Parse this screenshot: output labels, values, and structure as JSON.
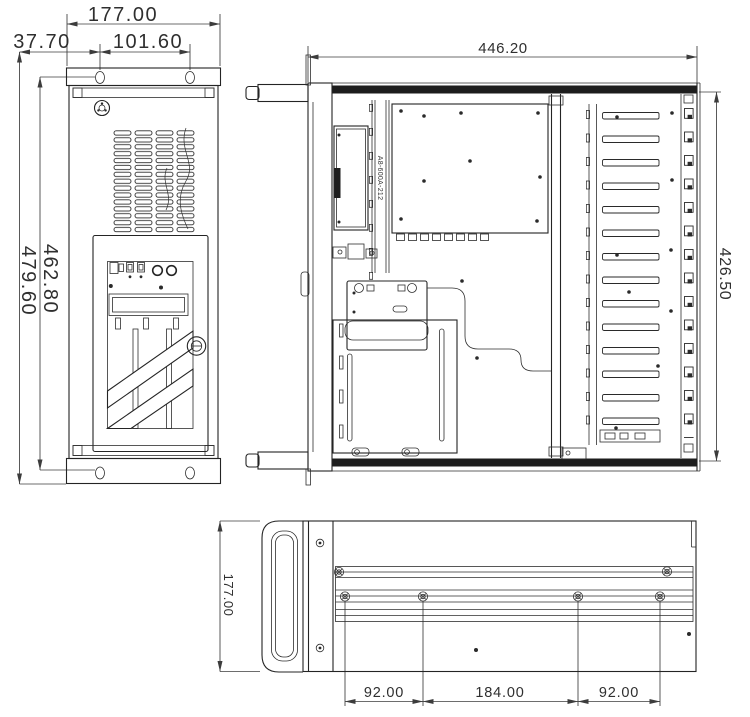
{
  "front": {
    "width": "177.00",
    "hole_offset": "37.70",
    "hole_spacing": "101.60",
    "inner_height": "462.80",
    "overall_height": "479.60"
  },
  "top": {
    "width": "446.20",
    "depth": "426.50",
    "bracket_text": "A8-600A-212"
  },
  "side": {
    "height": "177.00",
    "left_span": "92.00",
    "center_span": "184.00",
    "right_span": "92.00"
  },
  "colors": {
    "line": "#242424",
    "dimension": "#3c3c3c",
    "background": "#ffffff"
  }
}
